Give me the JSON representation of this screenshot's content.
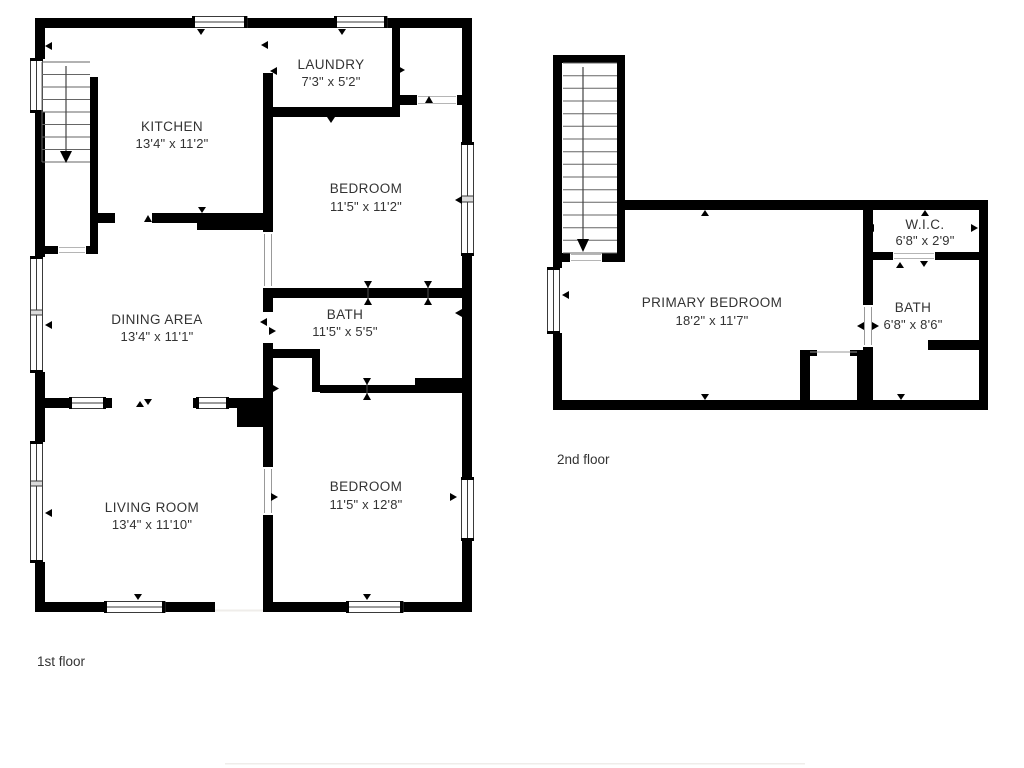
{
  "colors": {
    "background": "#ffffff",
    "wall": "#000000",
    "text": "#333333",
    "window_frame": "#3a3a3a",
    "stair": "#666666",
    "door_line": "#b5b5b5",
    "faint_line": "#efedea"
  },
  "floors": {
    "first": {
      "label": "1st floor",
      "rooms": {
        "kitchen": {
          "name": "KITCHEN",
          "dims": "13'4\" x 11'2\""
        },
        "laundry": {
          "name": "LAUNDRY",
          "dims": "7'3\" x 5'2\""
        },
        "bedroom_upper": {
          "name": "BEDROOM",
          "dims": "11'5\" x 11'2\""
        },
        "dining": {
          "name": "DINING AREA",
          "dims": "13'4\" x 11'1\""
        },
        "bath": {
          "name": "BATH",
          "dims": "11'5\" x 5'5\""
        },
        "living": {
          "name": "LIVING ROOM",
          "dims": "13'4\" x 11'10\""
        },
        "bedroom_lower": {
          "name": "BEDROOM",
          "dims": "11'5\" x 12'8\""
        }
      }
    },
    "second": {
      "label": "2nd floor",
      "rooms": {
        "primary_bedroom": {
          "name": "PRIMARY BEDROOM",
          "dims": "18'2\" x 11'7\""
        },
        "wic": {
          "name": "W.I.C.",
          "dims": "6'8\" x 2'9\""
        },
        "bath": {
          "name": "BATH",
          "dims": "6'8\" x 8'6\""
        }
      }
    }
  }
}
